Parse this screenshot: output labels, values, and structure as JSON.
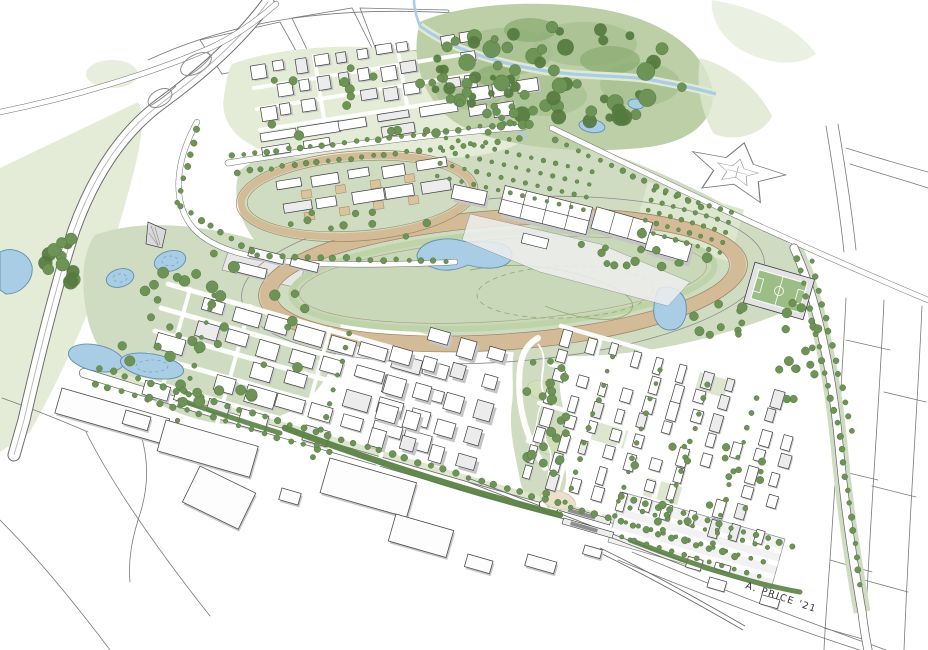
{
  "signature": {
    "text": "A. PRICE '21"
  },
  "palette": {
    "paper": "#ffffff",
    "line": "#404040",
    "line_soft": "#8c8c8c",
    "grass": "#cfdcc1",
    "grass_pale": "#dde7cf",
    "meadow": "#e4ecd8",
    "infield": "#c9d8b9",
    "forest_base": "#bccfa6",
    "canopy": "#a8c192",
    "canopy_dark": "#8fae76",
    "tree": "#6d9357",
    "tree_dark": "#55793f",
    "hedge": "#5a8244",
    "water": "#a9cde4",
    "water_edge": "#5f8fae",
    "track_dirt": "#d4bb97",
    "track_edge": "#9b8867",
    "paddock": "#d9c49e",
    "pitch": "#9cbd85",
    "plaza": "#e9e1cb",
    "building": "#ffffff",
    "bside": "#c6c6c6",
    "broof": "#ececec",
    "sig": "#323232"
  },
  "scene": {
    "districts": [
      [
        "west-grid",
        "city",
        172,
        288,
        16,
        9,
        5,
        33,
        24,
        24,
        14,
        0.12,
        2
      ],
      [
        "south-towers",
        "city",
        402,
        320,
        16,
        4,
        5,
        31,
        28,
        17,
        15,
        0.1,
        3.5
      ],
      [
        "se-rowhouses",
        "city",
        565,
        330,
        16,
        11,
        8,
        24,
        20,
        9,
        15,
        0.15,
        1.5
      ],
      [
        "north-towers",
        "city",
        252,
        66,
        -9,
        11,
        3,
        21,
        21,
        13,
        12,
        0.18,
        2
      ],
      [
        "north-bars",
        "city",
        260,
        134,
        -9,
        5,
        2,
        40,
        13,
        34,
        9,
        0.25,
        1.2
      ],
      [
        "campus",
        "city",
        464,
        88,
        -9,
        3,
        2,
        27,
        20,
        19,
        12,
        0.1,
        2
      ],
      [
        "stables",
        "stables",
        278,
        182,
        -9,
        5,
        2,
        35,
        22,
        26,
        10,
        0,
        1
      ],
      [
        "bottom-strip",
        "city",
        690,
        556,
        16,
        4,
        2,
        26,
        16,
        16,
        9,
        0.2,
        1.2
      ]
    ],
    "context_buildings": [
      [
        62,
        388,
        112,
        26,
        16
      ],
      [
        126,
        410,
        26,
        14,
        16
      ],
      [
        166,
        420,
        96,
        32,
        16
      ],
      [
        200,
        466,
        62,
        40,
        26
      ],
      [
        282,
        488,
        20,
        12,
        16
      ],
      [
        330,
        458,
        90,
        36,
        16
      ],
      [
        396,
        514,
        60,
        28,
        16
      ],
      [
        468,
        554,
        26,
        13,
        16
      ],
      [
        528,
        554,
        30,
        12,
        16
      ],
      [
        585,
        545,
        18,
        9,
        16
      ],
      [
        250,
        247,
        36,
        9,
        14
      ],
      [
        238,
        262,
        30,
        10,
        14
      ],
      [
        292,
        257,
        28,
        9,
        14
      ]
    ],
    "paddocks": [
      [
        301,
        191
      ],
      [
        335,
        186
      ],
      [
        370,
        181
      ],
      [
        404,
        175
      ],
      [
        304,
        213
      ],
      [
        339,
        208
      ],
      [
        373,
        202
      ],
      [
        408,
        197
      ]
    ],
    "tree_rows": [
      [
        100,
        368,
        735,
        556,
        13,
        3
      ],
      [
        95,
        384,
        330,
        452,
        13,
        2.8
      ],
      [
        232,
        156,
        514,
        123,
        11,
        2.6
      ],
      [
        238,
        172,
        520,
        139,
        11,
        2.6
      ],
      [
        196,
        130,
        178,
        203,
        12,
        2.8
      ],
      [
        180,
        207,
        252,
        252,
        12,
        2.8
      ],
      [
        258,
        255,
        446,
        262,
        12,
        2.8
      ],
      [
        797,
        258,
        840,
        436,
        13,
        2.8
      ],
      [
        840,
        436,
        860,
        584,
        13,
        2.8
      ],
      [
        812,
        262,
        852,
        430,
        14,
        2.6
      ],
      [
        556,
        140,
        700,
        206,
        12,
        2.6
      ],
      [
        622,
        496,
        792,
        546,
        12,
        2.8
      ],
      [
        612,
        356,
        566,
        502,
        14,
        2.4
      ],
      [
        660,
        370,
        614,
        516,
        14,
        2.4
      ],
      [
        708,
        384,
        662,
        530,
        14,
        2.4
      ],
      [
        756,
        398,
        712,
        544,
        14,
        2.4
      ],
      [
        214,
        296,
        177,
        420,
        14,
        2.4
      ],
      [
        350,
        334,
        313,
        458,
        14,
        2.4
      ]
    ],
    "tree_clusters": [
      [
        555,
        78,
        135,
        52,
        48,
        4,
        9,
        1
      ],
      [
        480,
        70,
        55,
        38,
        16,
        3,
        7,
        1
      ],
      [
        205,
        330,
        105,
        80,
        40,
        3,
        6,
        0
      ],
      [
        375,
        105,
        125,
        42,
        22,
        3,
        5,
        0
      ],
      [
        548,
        420,
        24,
        78,
        22,
        3,
        5,
        0
      ],
      [
        800,
        350,
        22,
        70,
        16,
        3,
        5,
        0
      ],
      [
        640,
        255,
        70,
        28,
        14,
        3,
        5,
        0
      ],
      [
        68,
        262,
        26,
        24,
        12,
        5,
        8,
        1
      ],
      [
        700,
        480,
        70,
        55,
        16,
        2.5,
        4,
        0
      ],
      [
        505,
        122,
        26,
        16,
        9,
        3,
        5,
        0
      ],
      [
        350,
        225,
        80,
        18,
        10,
        2.5,
        4,
        0
      ],
      [
        730,
        320,
        40,
        20,
        10,
        3,
        5,
        0
      ]
    ],
    "dot_grids": [
      [
        654,
        190,
        16,
        8,
        5,
        11.5,
        10.5,
        2.2
      ],
      [
        446,
        138,
        13,
        13,
        4,
        12.5,
        13,
        2.1
      ],
      [
        630,
        508,
        16,
        12,
        3,
        13,
        15,
        2.2
      ]
    ]
  }
}
